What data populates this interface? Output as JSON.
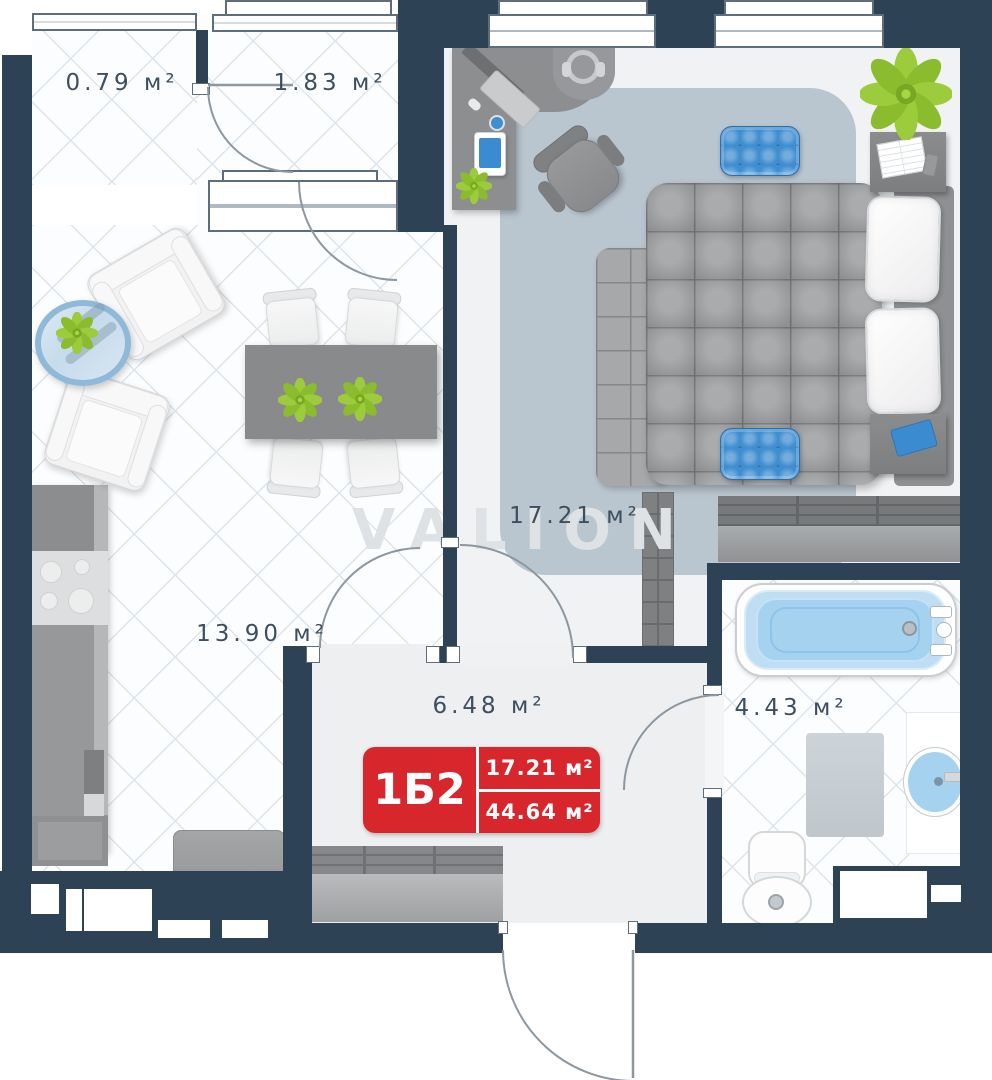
{
  "watermark": "VALION",
  "badge": {
    "unit": "1Б2",
    "room_area": "17.21 м²",
    "total_area": "44.64 м²"
  },
  "rooms": {
    "balcony_small": {
      "area": "0.79 м²"
    },
    "balcony_large": {
      "area": "1.83 м²"
    },
    "bedroom": {
      "area": "17.21 м²"
    },
    "living_kitchen": {
      "area": "13.90 м²"
    },
    "hallway": {
      "area": "6.48 м²"
    },
    "bathroom": {
      "area": "4.43 м²"
    }
  },
  "colors": {
    "wall": "#2d4254",
    "badge_red": "#d7262c",
    "label_text": "#3d4e5f",
    "watermark_gray": "#dfe2e4",
    "pouf_blue": "#3f8ed0",
    "water_blue": "#a5d2ef",
    "rug_gray_blue": "#b9c5cf",
    "plant_green": "#96c93d"
  }
}
